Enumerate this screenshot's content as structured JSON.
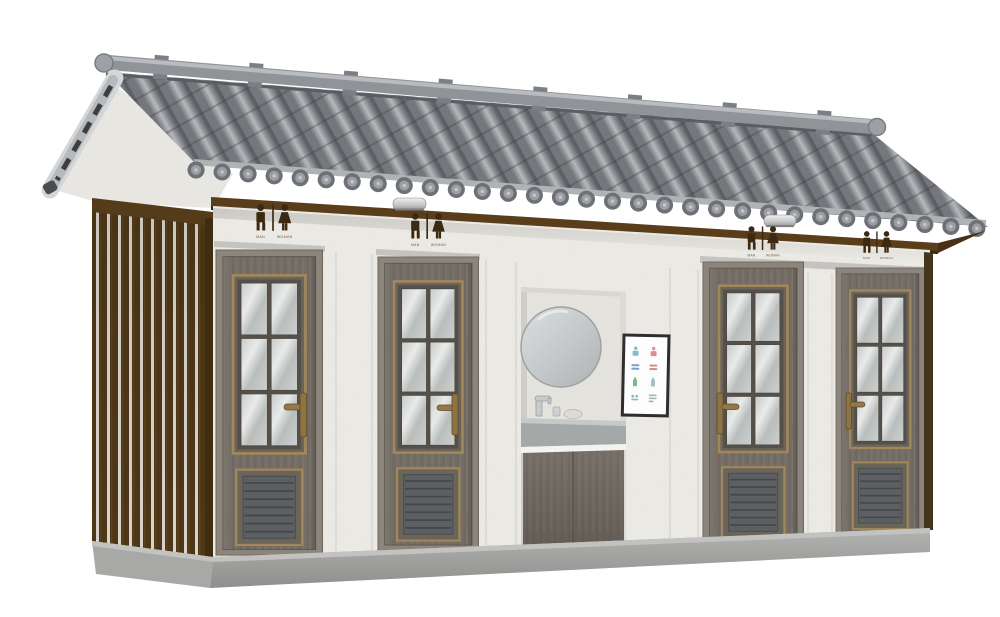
{
  "scene": {
    "subject": "prefabricated public restroom building, chinese gray-tile roof, 3d product render",
    "background_color": "#ffffff"
  },
  "palette": {
    "roof_tile": "#85888c",
    "roof_tile_highlight": "#b6b9bc",
    "roof_ridge": "#909397",
    "bargeboard_gray": "#c0c3c5",
    "fascia_wood": "#5a3d1a",
    "slat_wood": "#4e3717",
    "slat_gap": "#d8d4cb",
    "wall_stucco": "#f0eee8",
    "door_wood": "#746e66",
    "door_casing": "#8b857c",
    "trim_brass": "#a3875a",
    "glass": "#c9cdcc",
    "vent_gray": "#5d6063",
    "sign_brown": "#3b2a11",
    "base_concrete": "#9c9c9a",
    "counter_gray": "#a7abac",
    "poster_frame": "#2e2e30"
  },
  "building": {
    "signs": [
      {
        "male_label": "MAN",
        "female_label": "WOMAN"
      },
      {
        "male_label": "MAN",
        "female_label": "WOMAN"
      },
      {
        "male_label": "MAN",
        "female_label": "WOMAN"
      },
      {
        "male_label": "MAN",
        "female_label": "WOMAN"
      }
    ],
    "doors": [
      {
        "name": "restroom-door-1",
        "glass_panes": 6,
        "handle_side": "right",
        "has_vent": true
      },
      {
        "name": "restroom-door-2",
        "glass_panes": 6,
        "handle_side": "right",
        "has_vent": true
      },
      {
        "name": "restroom-door-3",
        "glass_panes": 6,
        "handle_side": "left",
        "has_vent": true
      },
      {
        "name": "restroom-door-4",
        "glass_panes": 6,
        "handle_side": "left",
        "has_vent": true
      }
    ],
    "lamps": {
      "count": 2
    },
    "washstand": {
      "mirror_shape": "round",
      "has_faucet": true,
      "has_soap_dish": true
    },
    "poster": {
      "rows": 4,
      "cols": 2,
      "icon_colors": [
        "#7fbfc9",
        "#e08c8c",
        "#7c9fd0",
        "#d98a85",
        "#7cb98c",
        "#9fc4c9",
        "#7cc4b8",
        "#aab2b6"
      ]
    },
    "roof": {
      "ridge_ornament_count": 8,
      "eave_cap_shape": "round"
    }
  }
}
